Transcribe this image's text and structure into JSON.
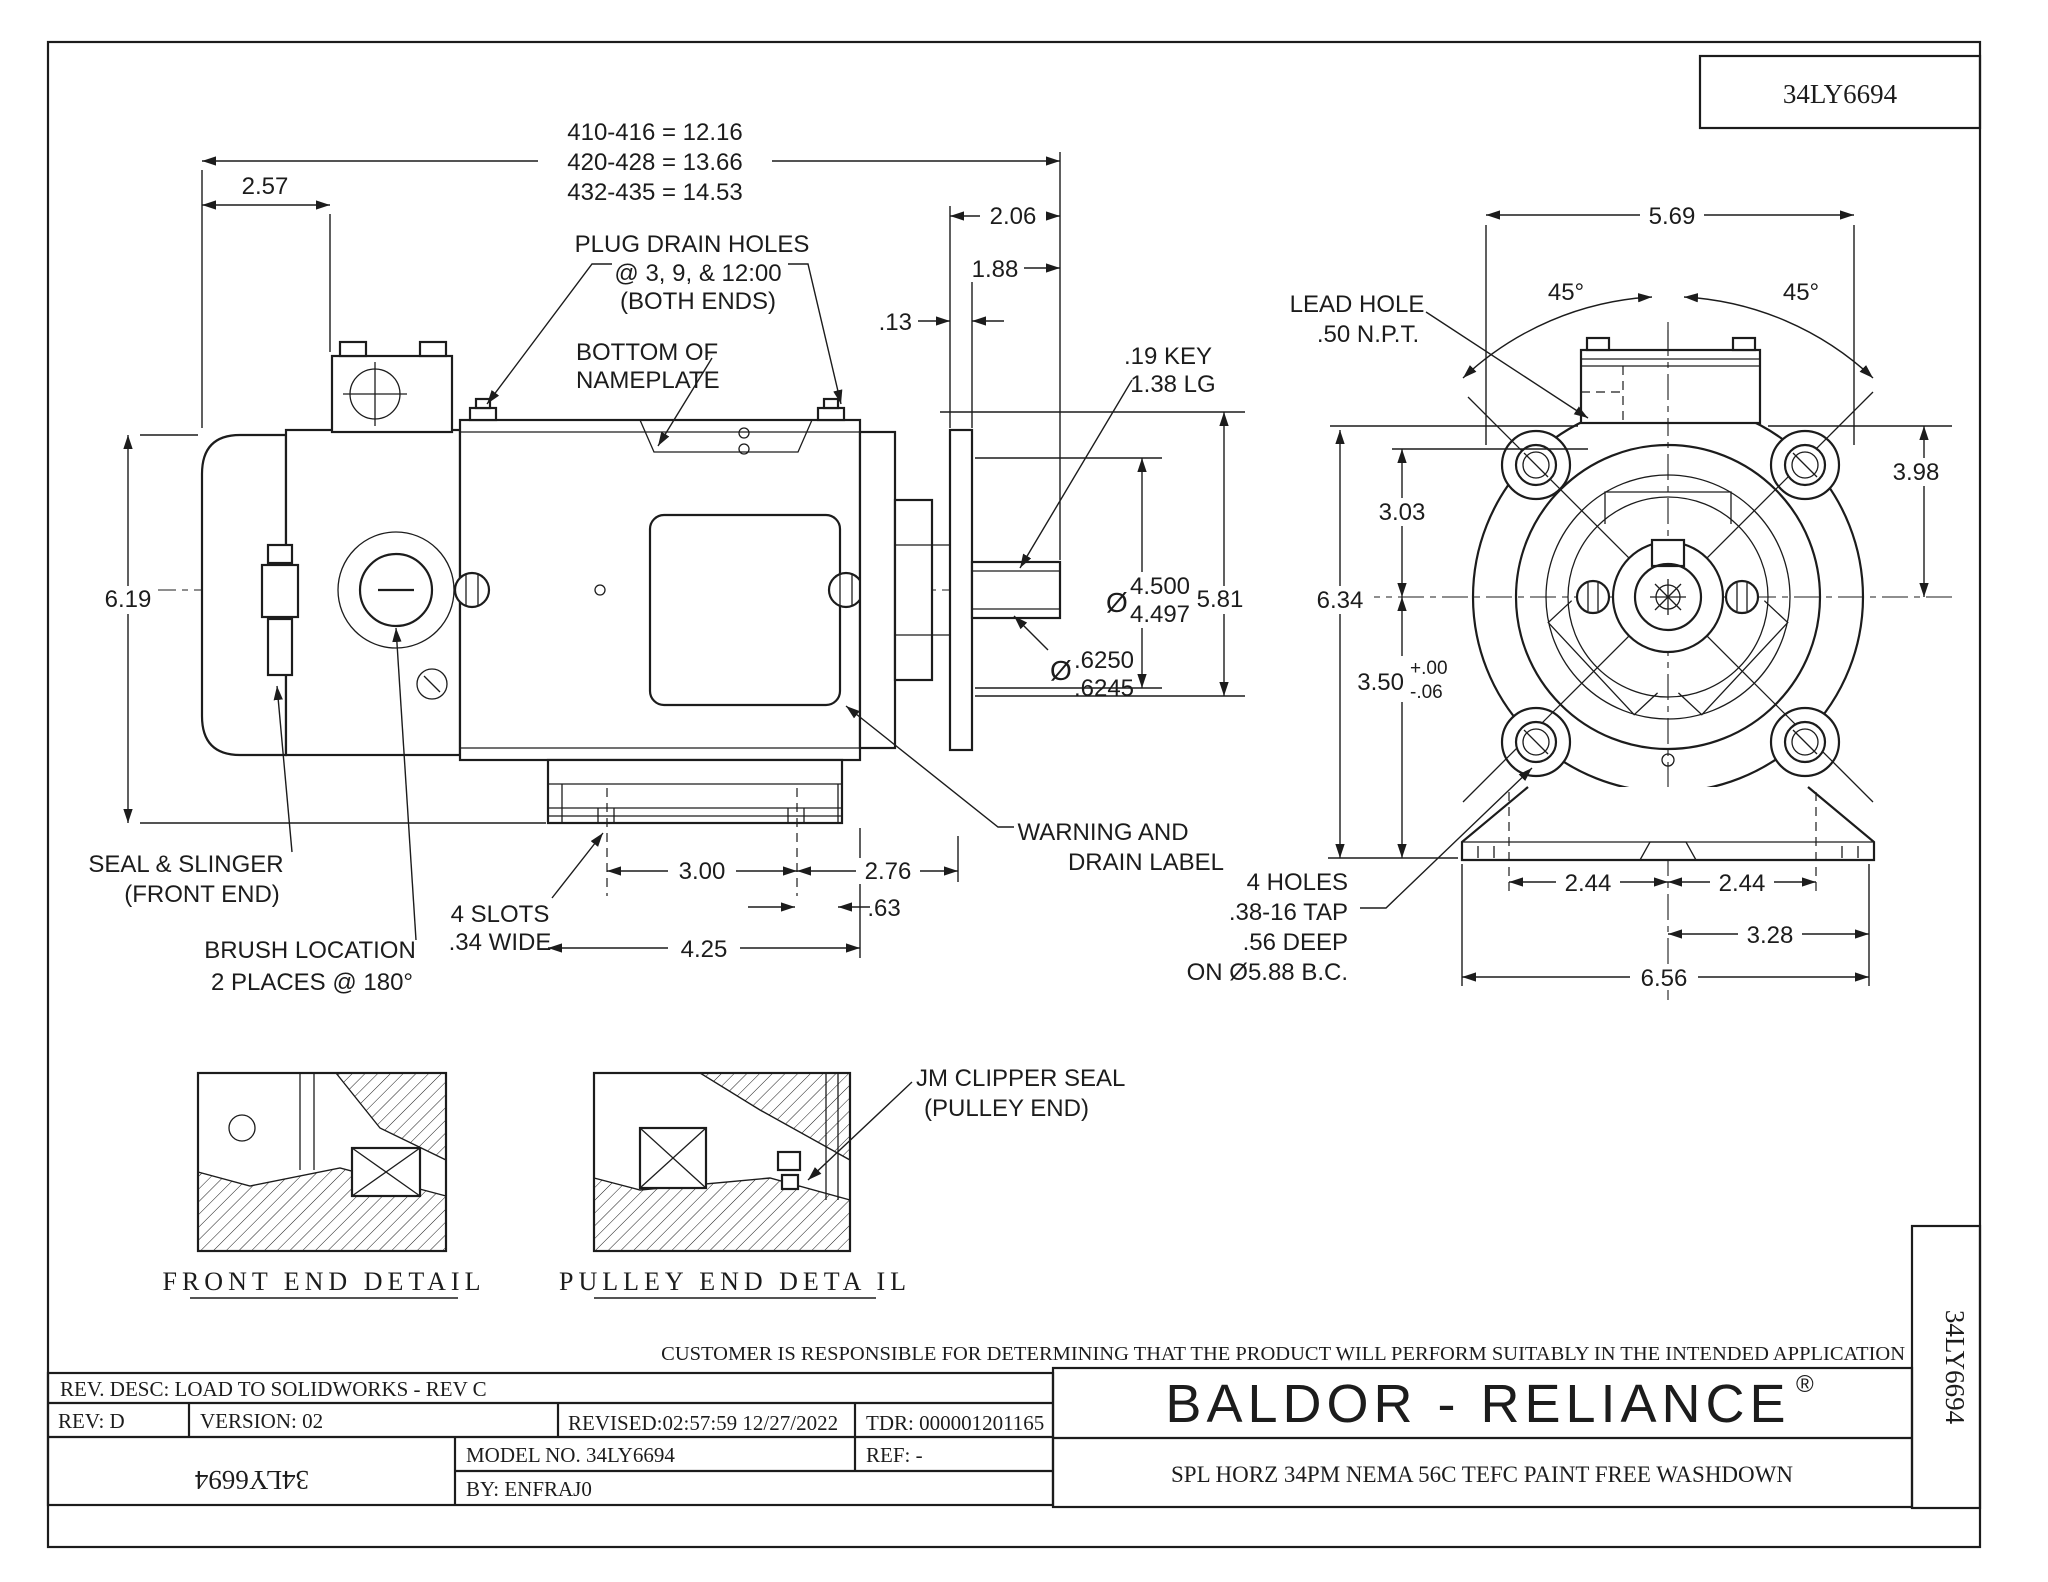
{
  "sheet": {
    "part_number": "34LY6694"
  },
  "title_block": {
    "customer_note": "CUSTOMER IS RESPONSIBLE FOR DETERMINING THAT THE PRODUCT WILL PERFORM SUITABLY IN THE INTENDED APPLICATION",
    "brand": "BALDOR - RELIANCE",
    "reg_mark": "®",
    "description": "SPL HORZ 34PM NEMA 56C TEFC PAINT FREE WASHDOWN",
    "rev_desc": "REV. DESC: LOAD TO SOLIDWORKS - REV C",
    "rev": "REV:  D",
    "version": "VERSION: 02",
    "revised": "REVISED:02:57:59 12/27/2022",
    "tdr": "TDR: 000001201165",
    "model_no": "MODEL NO.  34LY6694",
    "ref": "REF:  -",
    "by": "BY:   ENFRAJ0",
    "stamp_rotated": "34LY6694",
    "part_number_tab": "34LY6694"
  },
  "side_view": {
    "length_dims": [
      "410-416 = 12.16",
      "420-428 = 13.66",
      "432-435 = 14.53"
    ],
    "plug_note": [
      "PLUG DRAIN HOLES",
      "@ 3, 9, & 12:00",
      "(BOTH ENDS)"
    ],
    "nameplate_note": [
      "BOTTOM OF",
      "NAMEPLATE"
    ],
    "seal_note": [
      "SEAL & SLINGER",
      "(FRONT END)"
    ],
    "brush_note": [
      "BRUSH LOCATION",
      "2 PLACES @ 180°"
    ],
    "slots_note": [
      "4 SLOTS",
      ".34 WIDE"
    ],
    "warning_note": [
      "WARNING AND",
      "DRAIN LABEL"
    ],
    "key_note": [
      ".19 KEY",
      "1.38 LG"
    ],
    "dims": {
      "d257": "2.57",
      "d206": "2.06",
      "d188": "1.88",
      "d13": ".13",
      "d619": "6.19",
      "d581": "5.81",
      "d300": "3.00",
      "d276": "2.76",
      "d63": ".63",
      "d425": "4.25"
    },
    "shaft_dia": {
      "sym": "Ø",
      "upper": "4.500",
      "lower": "4.497"
    },
    "stub_dia": {
      "sym": "Ø",
      "upper": ".6250",
      "lower": ".6245"
    }
  },
  "front_view": {
    "lead_note": [
      "LEAD HOLE",
      ".50 N.P.T."
    ],
    "holes_note": [
      "4 HOLES",
      ".38-16 TAP",
      ".56 DEEP",
      "ON Ø5.88 B.C."
    ],
    "dims": {
      "d569": "5.69",
      "d398": "3.98",
      "d303": "3.03",
      "d634": "6.34",
      "d350": "3.50",
      "tolp": "+.00",
      "tolm": "-.06",
      "d244a": "2.44",
      "d244b": "2.44",
      "d328": "3.28",
      "d656": "6.56",
      "a45l": "45°",
      "a45r": "45°"
    }
  },
  "details": {
    "front_caption": "FRONT  END  DETAIL",
    "pulley_caption": "PULLEY  END  DETA IL",
    "jm_note": [
      "JM CLIPPER SEAL",
      "(PULLEY END)"
    ]
  }
}
